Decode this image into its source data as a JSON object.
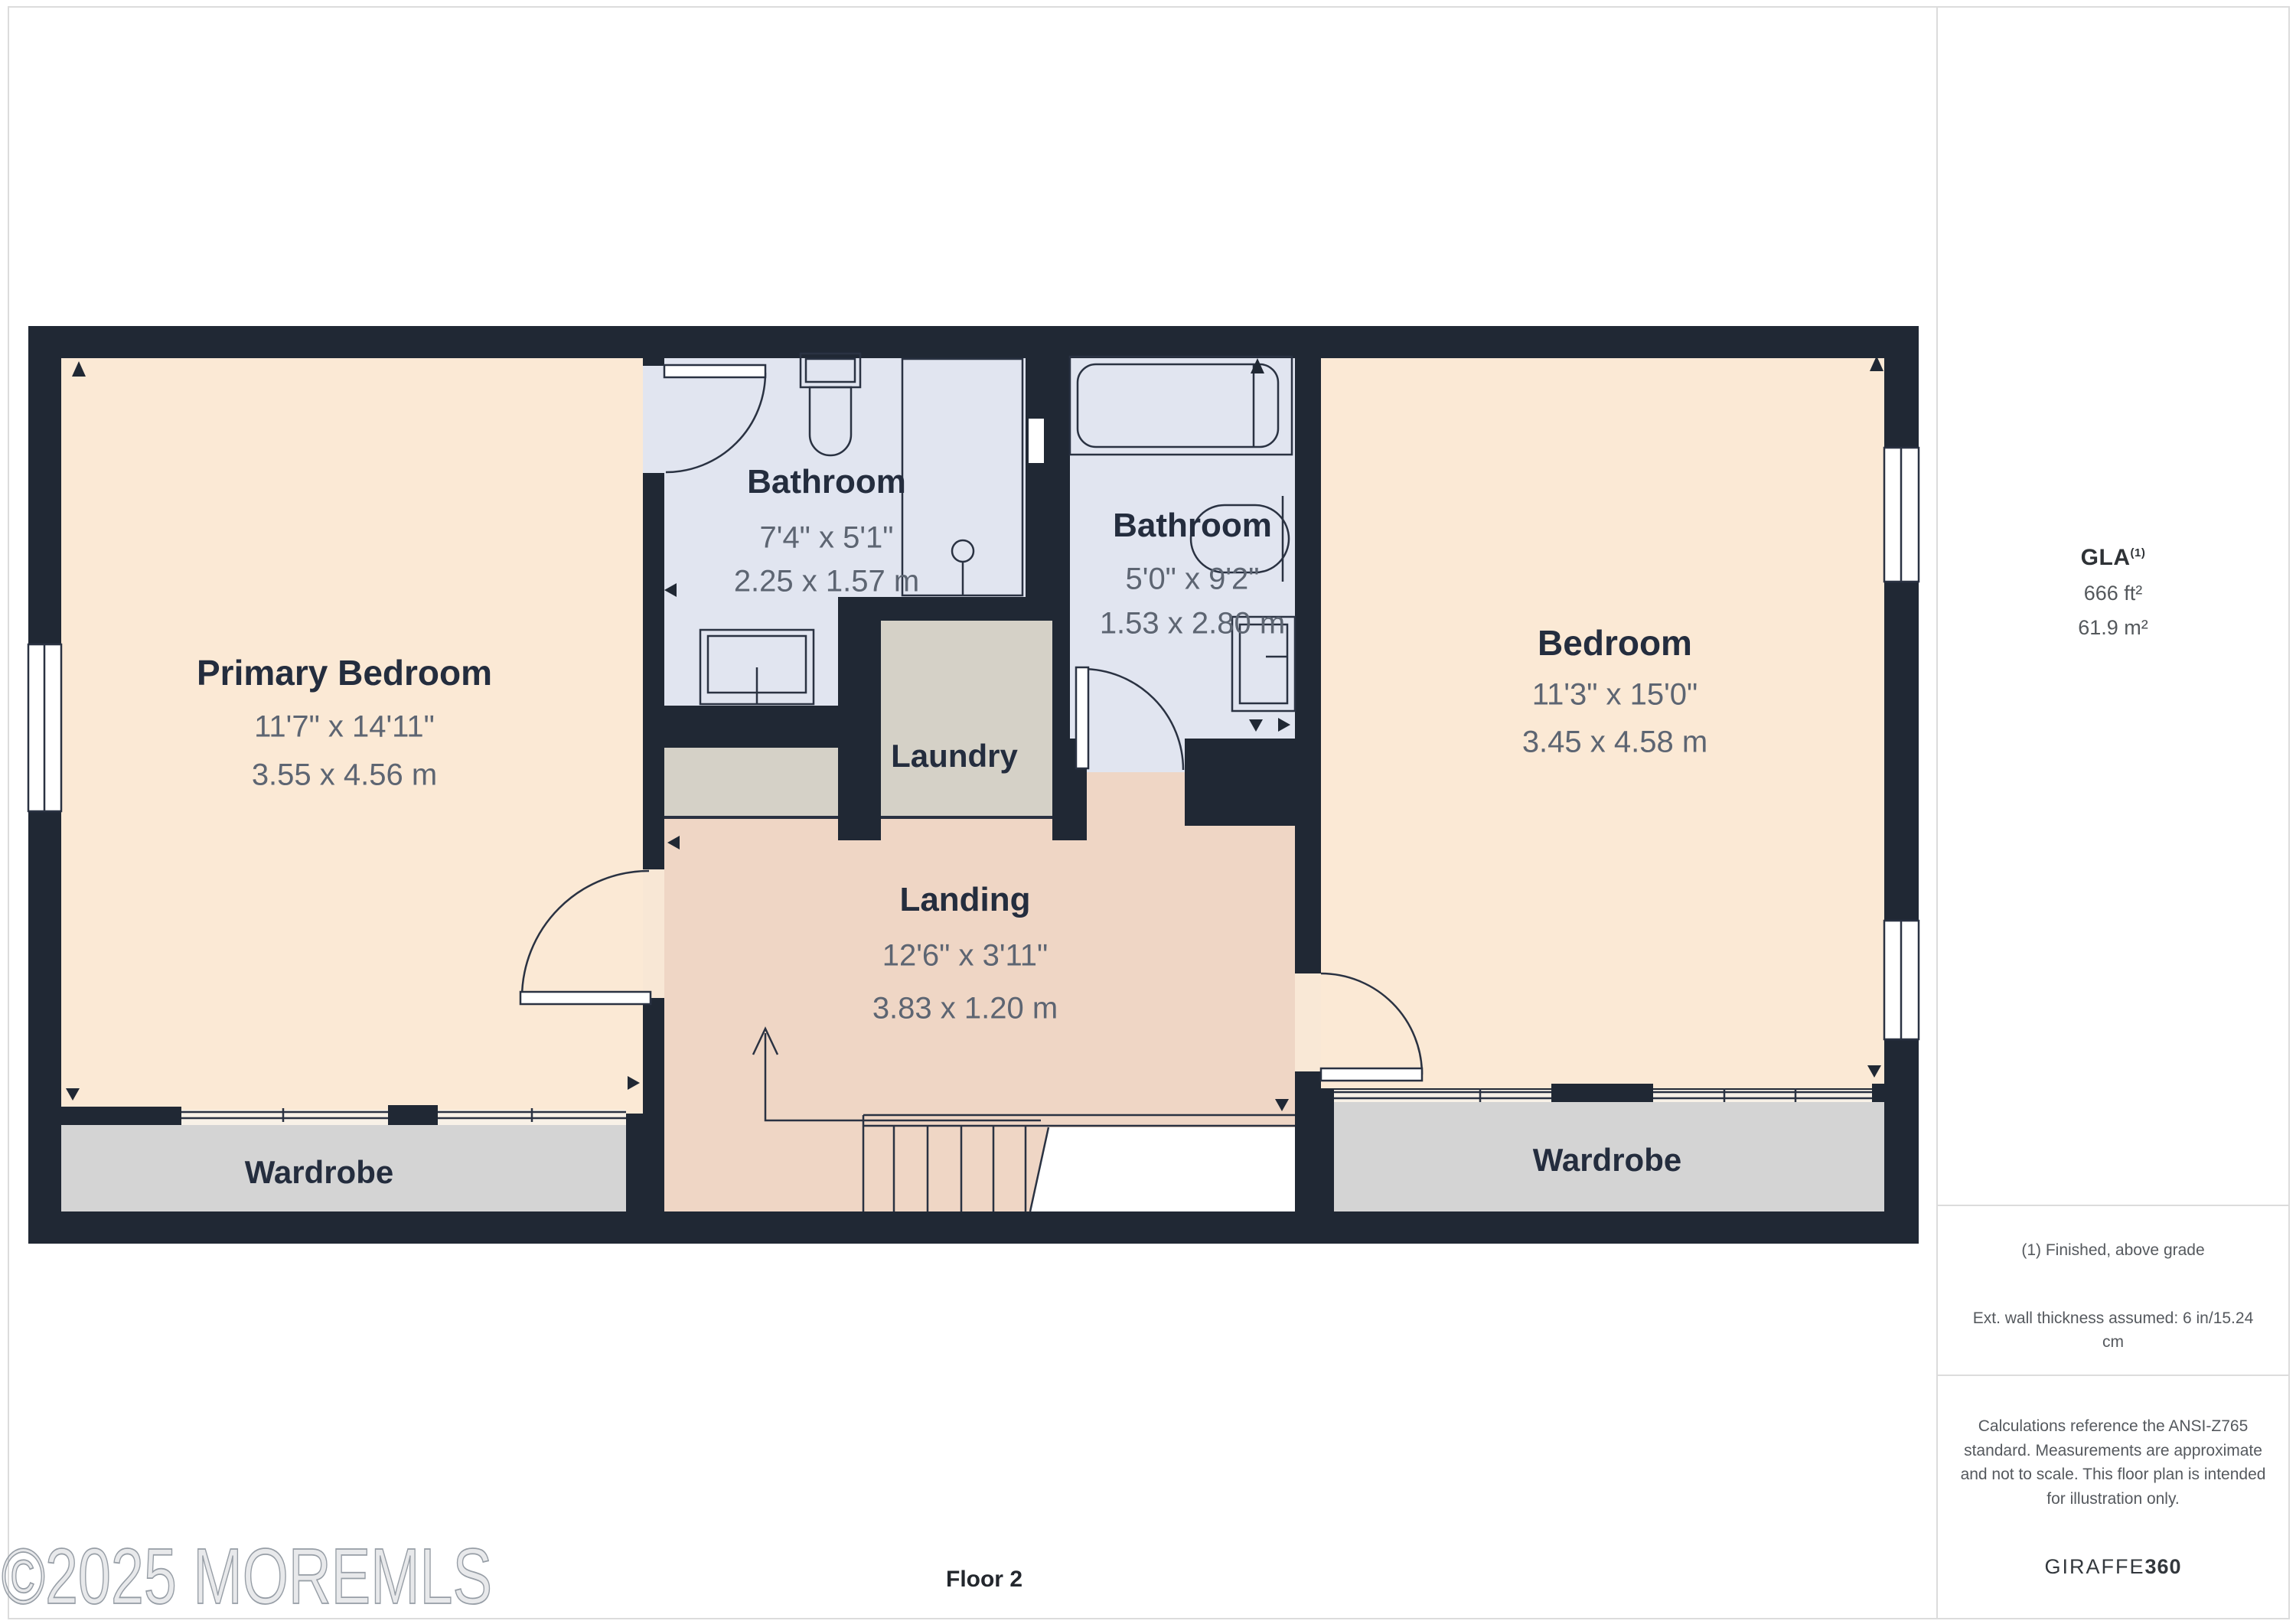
{
  "page": {
    "floor_label": "Floor 2",
    "watermark": "©2025 MOREMLS"
  },
  "rooms": [
    {
      "name": "Primary Bedroom",
      "imperial": "11'7\" x 14'11\"",
      "metric": "3.55 x 4.56 m"
    },
    {
      "name": "Bathroom",
      "imperial": "7'4\" x 5'1\"",
      "metric": "2.25 x 1.57 m"
    },
    {
      "name": "Bathroom",
      "imperial": "5'0\" x 9'2\"",
      "metric": "1.53 x 2.80 m"
    },
    {
      "name": "Laundry"
    },
    {
      "name": "Landing",
      "imperial": "12'6\" x 3'11\"",
      "metric": "3.83 x 1.20 m"
    },
    {
      "name": "Bedroom",
      "imperial": "11'3\" x 15'0\"",
      "metric": "3.45 x 4.58 m"
    },
    {
      "name": "Wardrobe"
    },
    {
      "name": "Wardrobe"
    }
  ],
  "sidebar": {
    "gla_title": "GLA",
    "gla_sup": "(1)",
    "gla_sqft": "666 ft²",
    "gla_sqm": "61.9 m²",
    "note_finished": "(1) Finished, above grade",
    "note_wall": "Ext. wall thickness assumed: 6 in/15.24 cm",
    "note_calc": "Calculations reference the ANSI-Z765 standard. Measurements are approximate and not to scale. This floor plan is intended for illustration only.",
    "brand": "GIRAFFE",
    "brand_suffix": "360"
  },
  "colors": {
    "wall": "#202834",
    "bedroom_floor": "#fbe9d5",
    "landing_floor": "#efd6c5",
    "bathroom_floor": "#e1e5f0",
    "wardrobe_floor": "#d4d4d4",
    "laundry_floor": "#d5d1c7",
    "label_dark": "#242d3e",
    "dim_gray": "#5d6572",
    "border_gray": "#dcdcdc"
  }
}
